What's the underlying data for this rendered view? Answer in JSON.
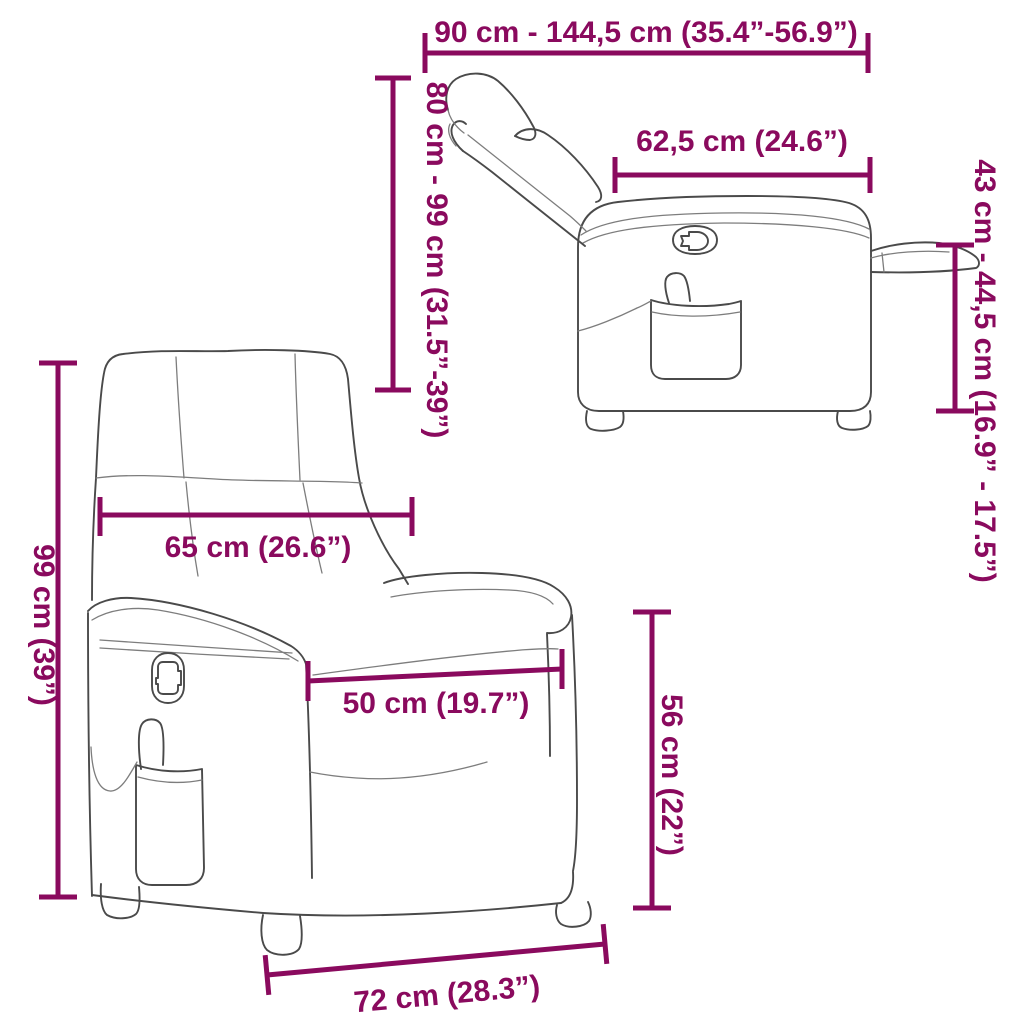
{
  "colors": {
    "accent": "#8a0a5e",
    "line": "#4a4a4a"
  },
  "diagram": {
    "subject": "recliner-chair-dimension-diagram",
    "labels": {
      "total_depth_range": "90 cm - 144,5 cm (35.4”-56.9”)",
      "recline_height_range": "80 cm - 99 cm (31.5”-39”)",
      "seat_back_depth": "62,5 cm (24.6”)",
      "footrest_height_range": "43 cm - 44,5 cm (16.9” - 17.5”)",
      "backrest_width": "65 cm (26.6”)",
      "total_height": "99 cm (39”)",
      "seat_width": "50 cm (19.7”)",
      "seat_height": "56 cm (22”)",
      "base_width": "72 cm (28.3”)"
    }
  }
}
